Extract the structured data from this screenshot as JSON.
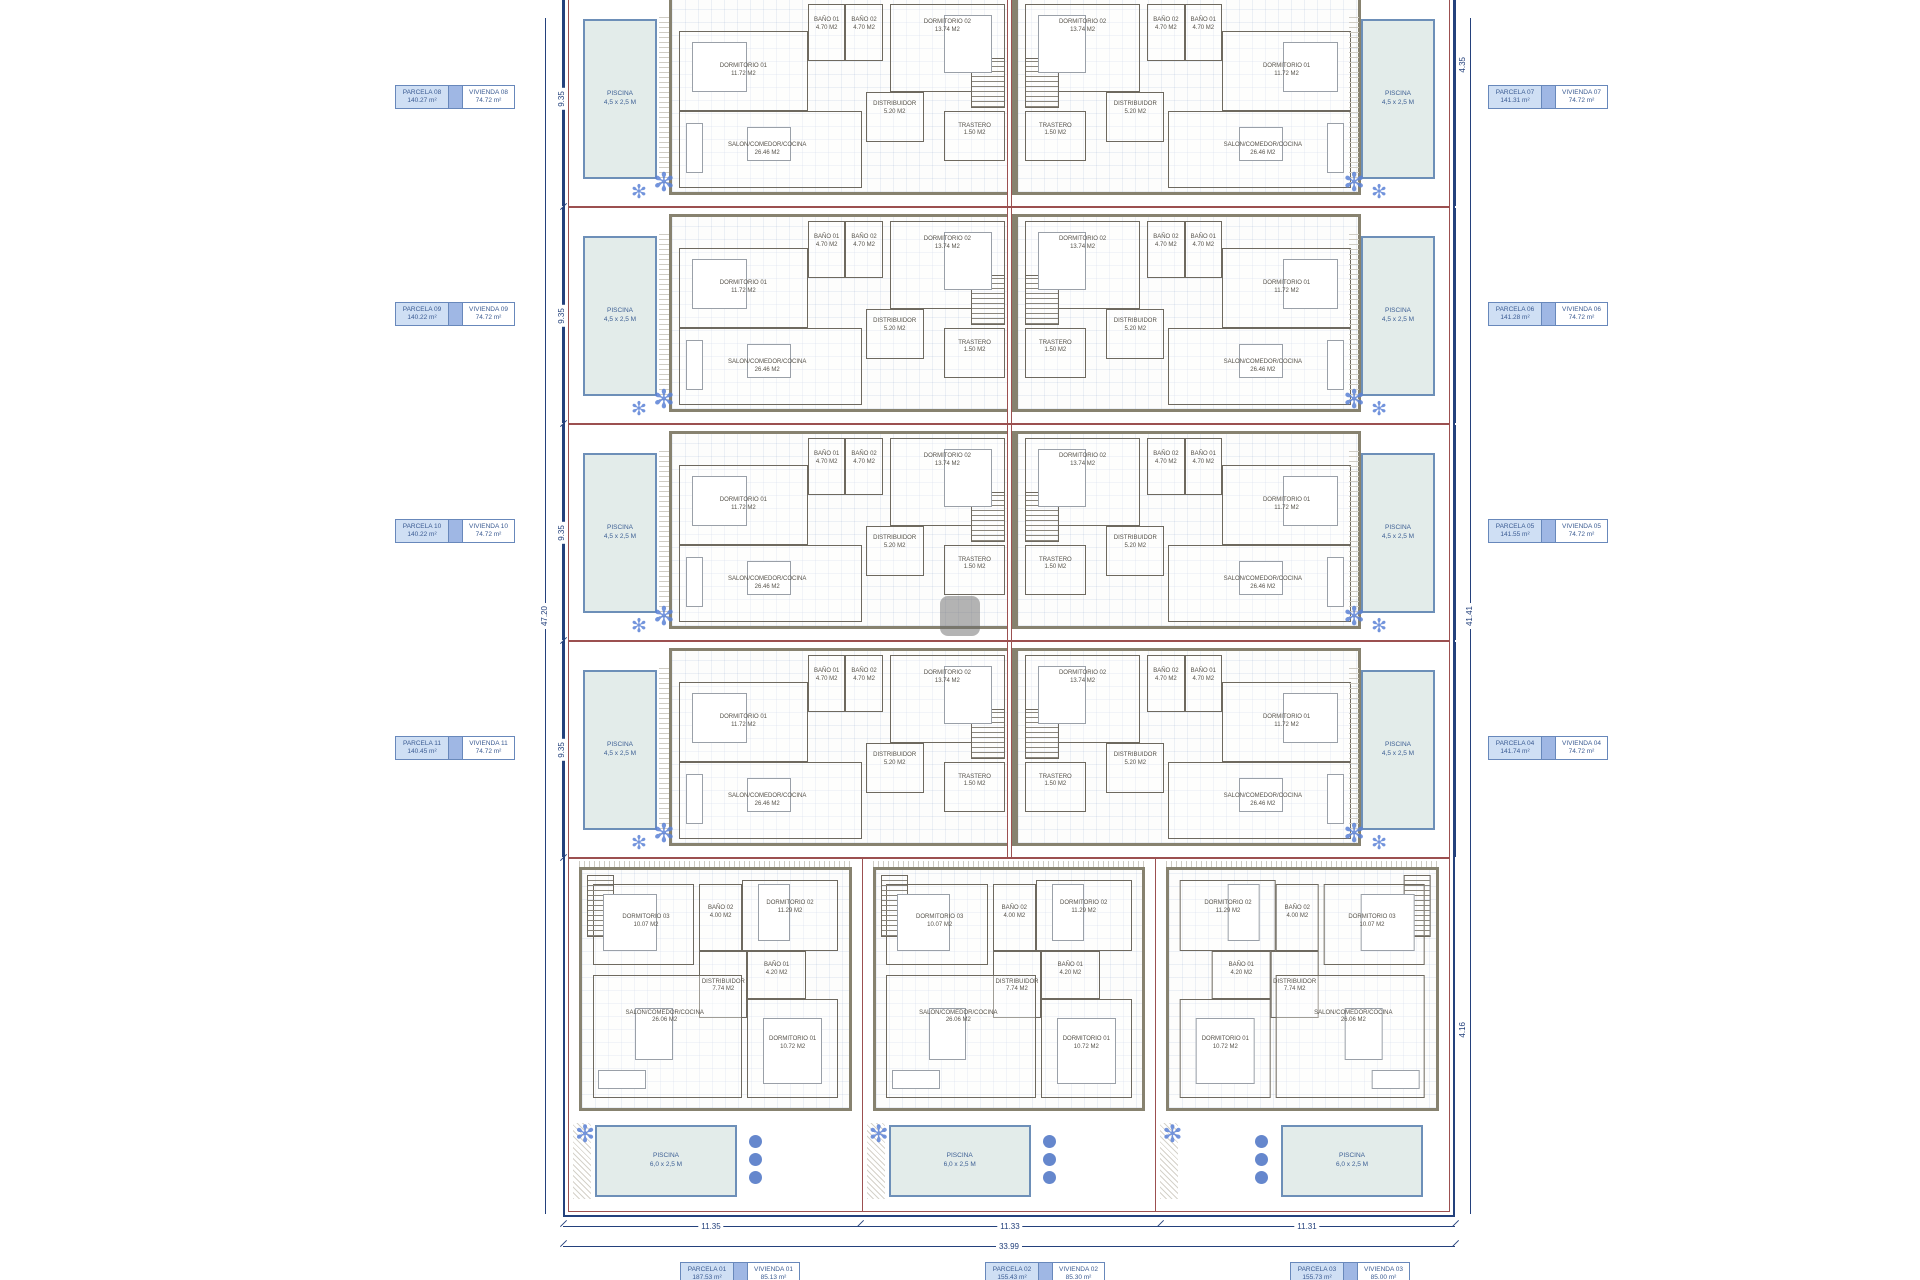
{
  "icons": {
    "plant": "✻"
  },
  "colors": {
    "boundary_navy": "#24417c",
    "parcel_red": "#9c5050",
    "wall_taupe": "#87826f",
    "pool_fill": "#e3ecea",
    "label_blue_fill": "#cfdff4",
    "label_mid_blue": "#9fb7e4",
    "label_text": "#3b5b92",
    "plant_blue": "#5b82d6"
  },
  "parcels": {
    "left": [
      {
        "parcel": "PARCELA 08",
        "parcel_area": "140.27 m²",
        "vivienda": "VIVIENDA 08",
        "vivienda_area": "74.72 m²"
      },
      {
        "parcel": "PARCELA 09",
        "parcel_area": "140.22 m²",
        "vivienda": "VIVIENDA 09",
        "vivienda_area": "74.72 m²"
      },
      {
        "parcel": "PARCELA 10",
        "parcel_area": "140.22 m²",
        "vivienda": "VIVIENDA 10",
        "vivienda_area": "74.72 m²"
      },
      {
        "parcel": "PARCELA 11",
        "parcel_area": "140.45 m²",
        "vivienda": "VIVIENDA 11",
        "vivienda_area": "74.72 m²"
      }
    ],
    "right": [
      {
        "parcel": "PARCELA 07",
        "parcel_area": "141.31 m²",
        "vivienda": "VIVIENDA 07",
        "vivienda_area": "74.72 m²"
      },
      {
        "parcel": "PARCELA 06",
        "parcel_area": "141.28 m²",
        "vivienda": "VIVIENDA 06",
        "vivienda_area": "74.72 m²"
      },
      {
        "parcel": "PARCELA 05",
        "parcel_area": "141.55 m²",
        "vivienda": "VIVIENDA 05",
        "vivienda_area": "74.72 m²"
      },
      {
        "parcel": "PARCELA 04",
        "parcel_area": "141.74 m²",
        "vivienda": "VIVIENDA 04",
        "vivienda_area": "74.72 m²"
      }
    ],
    "bottom": [
      {
        "parcel": "PARCELA 01",
        "parcel_area": "187.53 m²",
        "vivienda": "VIVIENDA 01",
        "vivienda_area": "85.13 m²"
      },
      {
        "parcel": "PARCELA 02",
        "parcel_area": "155.43 m²",
        "vivienda": "VIVIENDA 02",
        "vivienda_area": "85.30 m²"
      },
      {
        "parcel": "PARCELA 03",
        "parcel_area": "155.73 m²",
        "vivienda": "VIVIENDA 03",
        "vivienda_area": "85.00 m²"
      }
    ]
  },
  "unit_type_a": {
    "rooms": {
      "dormitorio1": {
        "label": "DORMITORIO 01",
        "area": "11.72 M2"
      },
      "dormitorio2": {
        "label": "DORMITORIO 02",
        "area": "13.74 M2"
      },
      "bano1": {
        "label": "BAÑO 01",
        "area": "4.70 M2"
      },
      "bano2": {
        "label": "BAÑO 02",
        "area": "4.70 M2"
      },
      "distribuidor": {
        "label": "DISTRIBUIDOR",
        "area": "5.20 M2"
      },
      "salon": {
        "label": "SALON/COMEDOR/COCINA",
        "area": "26.46 M2"
      },
      "trastero": {
        "label": "TRASTERO",
        "area": "1.50 M2"
      }
    },
    "pool_label": "PISCINA",
    "pool_size": "4,5 x 2,5 M"
  },
  "unit_type_b": {
    "rooms": {
      "dormitorio1": {
        "label": "DORMITORIO 01",
        "area": "10.72 M2"
      },
      "dormitorio2": {
        "label": "DORMITORIO 02",
        "area": "11.29 M2"
      },
      "dormitorio3": {
        "label": "DORMITORIO 03",
        "area": "10.07 M2"
      },
      "bano1": {
        "label": "BAÑO 01",
        "area": "4.20 M2"
      },
      "bano2": {
        "label": "BAÑO 02",
        "area": "4.00 M2"
      },
      "distribuidor": {
        "label": "DISTRIBUIDOR",
        "area": "7.74 M2"
      },
      "salon": {
        "label": "SALON/COMEDOR/COCINA",
        "area": "26.06 M2"
      }
    },
    "pool_label": "PISCINA",
    "pool_size": "6,0 x 2,5 M"
  },
  "dimensions": {
    "left_total": "47.20",
    "row_heights": [
      "9.35",
      "9.35",
      "9.35",
      "9.35"
    ],
    "right_total": "41.41",
    "right_top": "4.35",
    "right_bottom": "4.16",
    "bottom_segments": [
      "11.35",
      "11.33",
      "11.31"
    ],
    "bottom_total": "33.99"
  }
}
